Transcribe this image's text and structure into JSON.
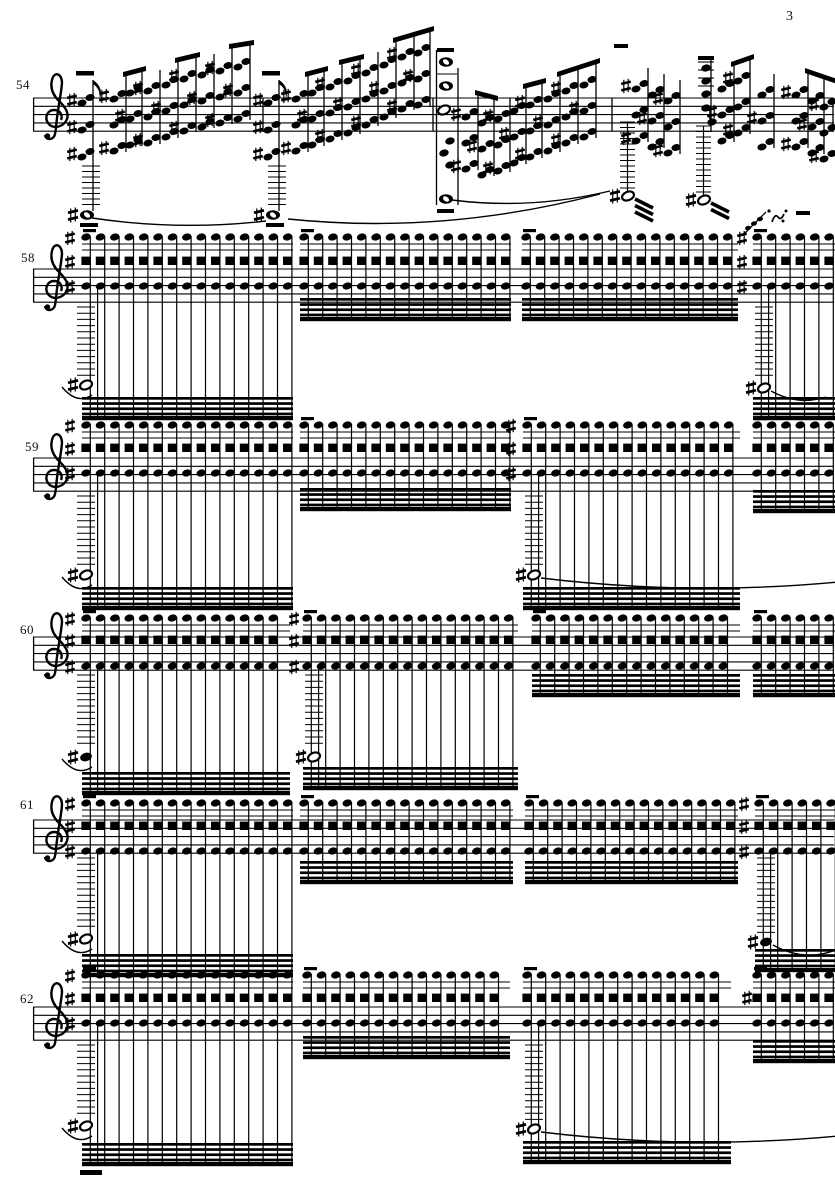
{
  "page": {
    "number": "3"
  },
  "score": {
    "clef": "treble",
    "accidental": "sharp",
    "systems": [
      {
        "measure": "54",
        "kind": "chords",
        "staff_top": 98,
        "bars": [
          263,
          433,
          612,
          833
        ],
        "measures": [
          {
            "anchor": {
              "x": 84,
              "top": 100,
              "note_y": 215,
              "flag": true
            },
            "cols": [
              [
                118,
                96
              ],
              [
                134,
                90
              ],
              [
                152,
                88
              ],
              [
                170,
                82
              ],
              [
                188,
                76
              ],
              [
                206,
                72
              ],
              [
                224,
                68
              ],
              [
                242,
                64
              ]
            ],
            "beams": [
              [
                118,
                134
              ],
              [
                170,
                188
              ],
              [
                224,
                242
              ]
            ],
            "tie": {
              "x1": 92,
              "y1": 218,
              "x2": 266,
              "y2": 221,
              "dip": 10
            }
          },
          {
            "anchor": {
              "x": 270,
              "top": 100,
              "note_y": 215,
              "flag": true
            },
            "cols": [
              [
                300,
                96
              ],
              [
                316,
                90
              ],
              [
                334,
                84
              ],
              [
                352,
                78
              ],
              [
                370,
                70
              ],
              [
                388,
                62
              ],
              [
                406,
                54
              ],
              [
                422,
                50
              ]
            ],
            "beams": [
              [
                300,
                316
              ],
              [
                334,
                352
              ],
              [
                388,
                422
              ]
            ],
            "tie": {
              "x1": 288,
              "y1": 219,
              "x2": 600,
              "y2": 194,
              "dip": 16
            }
          },
          {
            "cols": [
              [
                470,
                114
              ],
              [
                486,
                120
              ],
              [
                502,
                116
              ],
              [
                518,
                108
              ],
              [
                534,
                102
              ],
              [
                552,
                96
              ],
              [
                570,
                88
              ],
              [
                588,
                82
              ]
            ],
            "beams": [
              [
                470,
                486
              ],
              [
                518,
                534
              ],
              [
                552,
                588
              ]
            ],
            "breve_column": {
              "x": 446
            },
            "tie": {
              "x1": 452,
              "y1": 200,
              "x2": 610,
              "y2": 191,
              "dip": 10
            }
          },
          {
            "cols": [
              [
                640,
                86
              ],
              [
                656,
                92
              ],
              [
                672,
                98
              ],
              [
                726,
                86
              ],
              [
                742,
                78
              ],
              [
                766,
                92
              ],
              [
                800,
                92
              ],
              [
                816,
                98
              ],
              [
                828,
                104
              ]
            ],
            "beams": [
              [
                726,
                742
              ],
              [
                800,
                828
              ]
            ],
            "high_stack": {
              "x": 706
            },
            "half_flags": [
              {
                "x": 628,
                "y": 196,
                "bars": 3
              },
              {
                "x": 704,
                "y": 200,
                "bars": 2
              }
            ],
            "ornament": {
              "x": 772,
              "y": 213
            },
            "dashes": [
              [
                796,
                211,
                14
              ],
              [
                614,
                44,
                14
              ]
            ]
          }
        ]
      },
      {
        "measure": "58",
        "kind": "tremolo",
        "staff_top": 269,
        "rows": [
          237,
          261,
          286
        ],
        "groups": [
          {
            "x0": 82,
            "x1": 293,
            "beam_top": 397,
            "acc_x": 70,
            "bass": {
              "x": 86,
              "y": 385
            },
            "ladder": true,
            "tie": "left"
          },
          {
            "x0": 300,
            "x1": 511,
            "beam_top": 298
          },
          {
            "x0": 522,
            "x1": 738,
            "beam_top": 298
          },
          {
            "x0": 753,
            "x1": 836,
            "beam_top": 397,
            "acc_x": 742,
            "bass": {
              "x": 764,
              "y": 388
            },
            "ladder": true,
            "tie": "short",
            "grace": true
          }
        ]
      },
      {
        "measure": "59",
        "kind": "tremolo",
        "staff_top": 458,
        "rows": [
          425,
          448,
          473
        ],
        "groups": [
          {
            "x0": 82,
            "x1": 293,
            "beam_top": 587,
            "acc_x": 70,
            "bass": {
              "x": 86,
              "y": 575
            },
            "ladder": true,
            "tie": "left"
          },
          {
            "x0": 300,
            "x1": 511,
            "beam_top": 488
          },
          {
            "x0": 523,
            "x1": 740,
            "beam_top": 587,
            "acc_x": 511,
            "bass": {
              "x": 534,
              "y": 575
            },
            "ladder": true,
            "tie": "long"
          },
          {
            "x0": 753,
            "x1": 836,
            "beam_top": 490
          }
        ]
      },
      {
        "measure": "60",
        "kind": "tremolo",
        "staff_top": 637,
        "rows": [
          618,
          640,
          666
        ],
        "groups": [
          {
            "x0": 82,
            "x1": 290,
            "beam_top": 772,
            "acc_x": 70,
            "bass": {
              "x": 86,
              "y": 757,
              "filled": true
            },
            "ladder": true,
            "tie": "left"
          },
          {
            "x0": 303,
            "x1": 518,
            "beam_top": 767,
            "acc_x": 294,
            "bass": {
              "x": 314,
              "y": 757
            },
            "ladder": true
          },
          {
            "x0": 532,
            "x1": 740,
            "beam_top": 674
          },
          {
            "x0": 753,
            "x1": 836,
            "beam_top": 674
          }
        ]
      },
      {
        "measure": "61",
        "kind": "tremolo",
        "staff_top": 820,
        "rows": [
          803,
          826,
          851
        ],
        "groups": [
          {
            "x0": 82,
            "x1": 293,
            "beam_top": 954,
            "acc_x": 70,
            "bass": {
              "x": 86,
              "y": 939
            },
            "ladder": true,
            "tie": "left"
          },
          {
            "x0": 300,
            "x1": 513,
            "beam_top": 861
          },
          {
            "x0": 525,
            "x1": 738,
            "beam_top": 861
          },
          {
            "x0": 755,
            "x1": 836,
            "beam_top": 949,
            "acc_x": 744,
            "bass": {
              "x": 766,
              "y": 942,
              "filled": true
            },
            "ladder": true,
            "tie": "long"
          }
        ]
      },
      {
        "measure": "62",
        "kind": "tremolo",
        "staff_top": 1007,
        "rows": [
          975,
          998,
          1023
        ],
        "groups": [
          {
            "x0": 82,
            "x1": 293,
            "beam_top": 1143,
            "acc_x": 70,
            "bass": {
              "x": 86,
              "y": 1126
            },
            "ladder": true,
            "tie": "left",
            "under_dash": true
          },
          {
            "x0": 303,
            "x1": 510,
            "beam_top": 1036
          },
          {
            "x0": 523,
            "x1": 731,
            "beam_top": 1141,
            "bass": {
              "x": 534,
              "y": 1129
            },
            "ladder": true,
            "tie": "long"
          },
          {
            "x0": 753,
            "x1": 836,
            "beam_top": 1040,
            "acc_single": 747
          }
        ]
      }
    ]
  }
}
